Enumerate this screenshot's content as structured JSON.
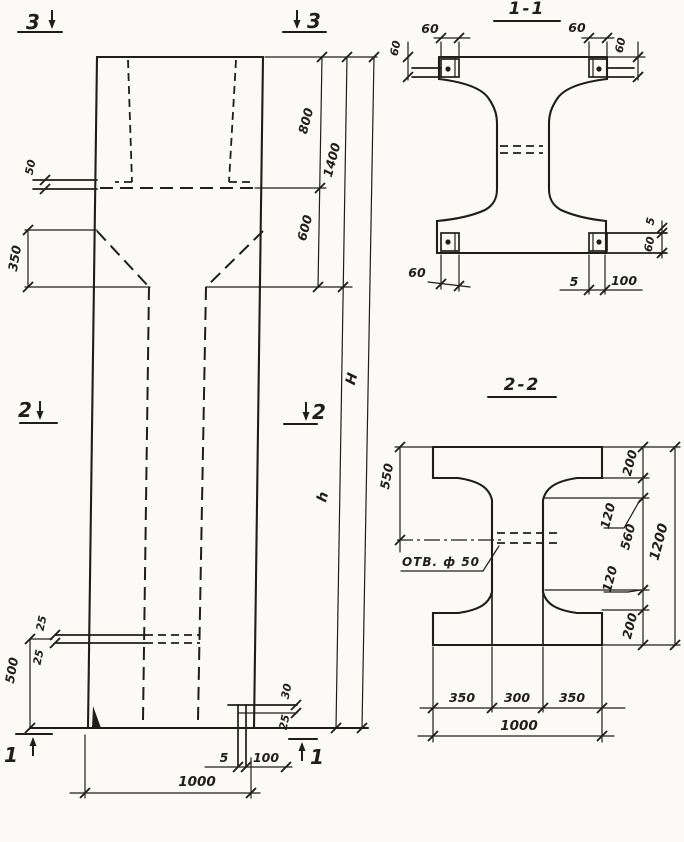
{
  "meta": {
    "drawing_type": "structural concrete column working drawing",
    "ink_color": "#211d18",
    "paper_color": "#fbfaf7"
  },
  "elevation": {
    "marker_3_left": "3",
    "marker_3_right": "3",
    "marker_2_left": "2",
    "marker_2_right": "2",
    "marker_1_left": "1",
    "marker_1_right": "1",
    "dim_50": "50",
    "dim_350": "350",
    "dim_800": "800",
    "dim_600": "600",
    "dim_1400": "1400",
    "dim_H": "H",
    "dim_h": "h",
    "dim_25_top": "25",
    "dim_25_bottom": "25",
    "dim_500": "500",
    "dim_30_foot": "30",
    "dim_25_foot": "25",
    "dim_5_foot": "5",
    "dim_100_foot": "100",
    "dim_1000": "1000"
  },
  "section_1_1": {
    "title": "1-1",
    "dim_60_top_left_h": "60",
    "dim_60_top_left_v": "60",
    "dim_60_top_right_h": "60",
    "dim_60_top_right_v": "60",
    "dim_60_bottom_left": "60",
    "dim_5_bottom": "5",
    "dim_100_bottom": "100",
    "dim_5_right": "5",
    "dim_60_right": "60"
  },
  "section_2_2": {
    "title": "2-2",
    "dim_550": "550",
    "hole_label": "ОТВ. ф 50",
    "dim_200_top": "200",
    "dim_120_top": "120",
    "dim_560": "560",
    "dim_120_bottom": "120",
    "dim_200_bottom": "200",
    "dim_1200": "1200",
    "dim_350_left": "350",
    "dim_300": "300",
    "dim_350_right": "350",
    "dim_1000": "1000"
  }
}
